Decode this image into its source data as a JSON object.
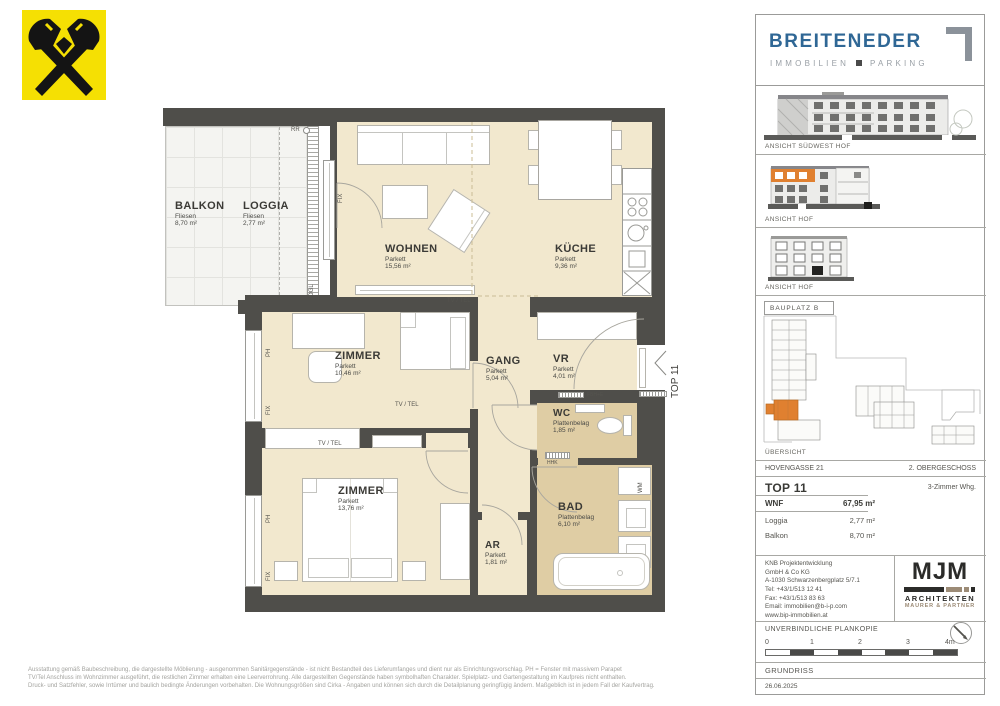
{
  "brand": {
    "name": "BREITENEDER",
    "subtitle_left": "IMMOBILIEN",
    "subtitle_right": "PARKING"
  },
  "sidebar": {
    "elevations": [
      "ANSICHT SÜDWEST HOF",
      "ANSICHT HOF",
      "ANSICHT HOF"
    ],
    "siteplan": {
      "bauplatz": "BAUPLATZ  B",
      "uebersicht": "ÜBERSICHT"
    },
    "unit": {
      "street": "HOVENGASSE 21",
      "floor": "2. OBERGESCHOSS",
      "top": "TOP 11",
      "type": "3-Zimmer Whg.",
      "metrics": [
        {
          "label": "WNF",
          "value": "67,95 m²"
        },
        {
          "label": "Loggia",
          "value": "2,77 m²"
        },
        {
          "label": "Balkon",
          "value": "8,70 m²"
        }
      ]
    },
    "contact": [
      "KNB Projektentwicklung",
      "GmbH & Co KG",
      "A-1030 Schwarzenbergplatz 5/7.1",
      "Tel: +43/1/513 12 41",
      "Fax: +43/1/513 83 63",
      "Email: immobilien@b-i-p.com",
      "www.bip-immobilien.at"
    ],
    "architect": {
      "name": "MJM",
      "line1": "ARCHITEKTEN",
      "line2": "MAURER & PARTNER"
    },
    "plankopie": "UNVERBINDLICHE PLANKOPIE",
    "scalebar_ticks": [
      "0",
      "1",
      "2",
      "3",
      "4m"
    ],
    "drawing_type": "GRUNDRISS",
    "date": "26.06.2025"
  },
  "plan": {
    "rooms": [
      {
        "name": "BALKON",
        "floor": "Fliesen",
        "area": "8,70 m²"
      },
      {
        "name": "LOGGIA",
        "floor": "Fliesen",
        "area": "2,77 m²"
      },
      {
        "name": "WOHNEN",
        "floor": "Parkett",
        "area": "15,56 m²"
      },
      {
        "name": "KÜCHE",
        "floor": "Parkett",
        "area": "9,36 m²"
      },
      {
        "name": "ZIMMER",
        "floor": "Parkett",
        "area": "10,46 m²"
      },
      {
        "name": "GANG",
        "floor": "Parkett",
        "area": "5,04 m²"
      },
      {
        "name": "VR",
        "floor": "Parkett",
        "area": "4,01 m²"
      },
      {
        "name": "WC",
        "floor": "Plattenbelag",
        "area": "1,85 m²"
      },
      {
        "name": "ZIMMER",
        "floor": "Parkett",
        "area": "13,76 m²"
      },
      {
        "name": "AR",
        "floor": "Parkett",
        "area": "1,81 m²"
      },
      {
        "name": "BAD",
        "floor": "Plattenbelag",
        "area": "6,10 m²"
      }
    ],
    "labels": {
      "unit_marker": "TOP 11",
      "tv_tel": "TV / TEL",
      "fix": "FIX",
      "ph": "PH",
      "rr": "RR",
      "kogl": "KOGL",
      "wm": "WM",
      "hhk": "HHK",
      "fbhe": "FBH+E"
    }
  },
  "disclaimer": [
    "Ausstattung gemäß Baubeschreibung, die dargestellte Möblierung - ausgenommen Sanitärgegenstände - ist nicht Bestandteil des Lieferumfanges und dient nur als Einrichtungsvorschlag. PH = Fenster mit massivem Parapet",
    "TV/Tel Anschluss im Wohnzimmer ausgeführt, die restlichen Zimmer erhalten eine Leerverrohrung. Alle dargestellten Gegenstände haben symbolhaften Charakter. Spielplatz- und Gartengestaltung im Kaufpreis nicht enthalten.",
    "Druck- und Satzfehler, sowie Irrtümer und baulich bedingte Änderungen vorbehalten. Die Wohnungsgrößen sind Cirka - Angaben und können sich durch die Detailplanung geringfügig ändern. Maßgeblich ist in jedem Fall der Kaufvertrag."
  ],
  "colors": {
    "wall": "#4f4e4a",
    "parkett": "#f2e8ce",
    "plattenbelag": "#dfcda4",
    "accent_orange": "#e08030",
    "brand_blue": "#2f6795",
    "raiffeisen_yellow": "#f5e003"
  }
}
